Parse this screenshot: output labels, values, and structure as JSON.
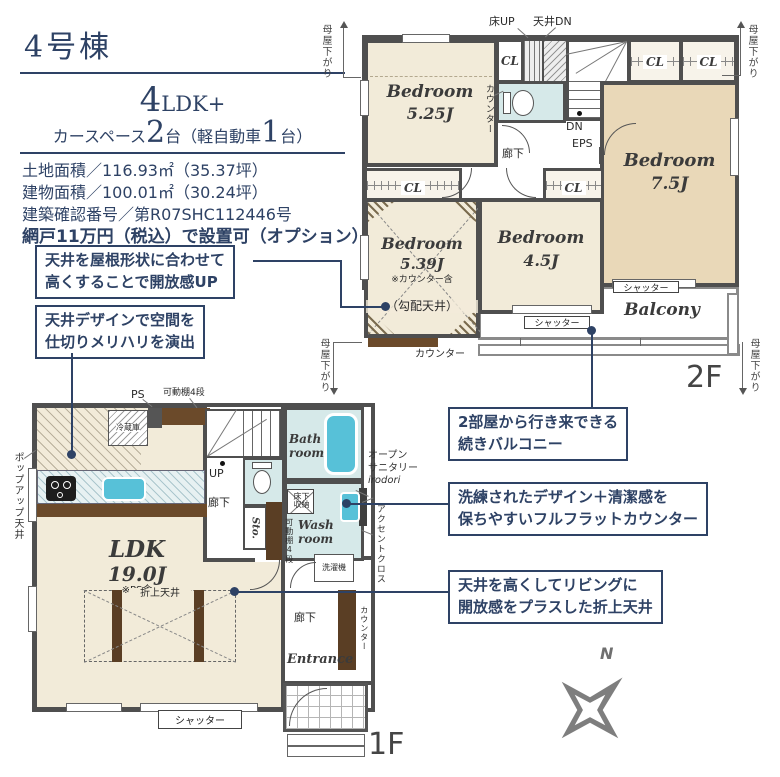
{
  "header": {
    "building": "4号棟",
    "plan_num": "4",
    "plan_rest": "LDK+",
    "car_prefix": "カースペース",
    "car_num1": "2",
    "car_mid": "台（軽自動車",
    "car_num2": "1",
    "car_suffix": "台）",
    "land": "土地面積／116.93㎡（35.37坪）",
    "bldg": "建物面積／100.01㎡（30.24坪）",
    "permit": "建築確認番号／第R07SHC112446号",
    "amido": "網戸11万円（税込）で設置可（オプション）"
  },
  "callouts": [
    {
      "line1": "天井を屋根形状に合わせて",
      "line2": "高くすることで開放感UP"
    },
    {
      "line1": "天井デザインで空間を",
      "line2": "仕切りメリハリを演出"
    },
    {
      "line1": "2部屋から行き来できる",
      "line2": "続きバルコニー"
    },
    {
      "line1": "洗練されたデザイン＋清潔感を",
      "line2": "保ちやすいフルフラットカウンター"
    },
    {
      "line1": "天井を高くしてリビングに",
      "line2": "開放感をプラスした折上天井"
    }
  ],
  "floor2": {
    "floor_label": "2F",
    "b1name": "Bedroom",
    "b1size": "5.25J",
    "b2name": "Bedroom",
    "b2size": "5.39J",
    "b2note": "※カウンター含",
    "b2ceil": "（勾配天井）",
    "b3name": "Bedroom",
    "b3size": "4.5J",
    "b4name": "Bedroom",
    "b4size": "7.5J",
    "balcony": "Balcony",
    "cl": "CL",
    "yuka_up": "床UP",
    "tenjo_dn": "天井DN",
    "dn": "DN",
    "eps": "EPS",
    "hallway": "廊下",
    "counter_side": "カウンター",
    "counter_bottom": "カウンター",
    "shutter": "シャッター",
    "moya": "母屋下がり"
  },
  "floor1": {
    "floor_label": "1F",
    "ldk": "LDK",
    "ldk_size": "19.0J",
    "ldk_note": "※PS含",
    "popup": "ポップアップ天井",
    "ps": "PS",
    "shelf_top": "可動棚4段",
    "fridge": "冷蔵庫",
    "up": "UP",
    "hall_up": "廊下",
    "sto": "Sto.",
    "bath1": "Bath",
    "bath2": "room",
    "wash1": "Wash",
    "wash2": "room",
    "ufs1": "床下",
    "ufs2": "収納",
    "shelf_v": "可動棚4段",
    "washer": "洗濯機",
    "osan1": "オープン",
    "osan2": "サニタリー",
    "osan3": "irodori",
    "accent": "アクセントクロス",
    "oriage": "折上天井",
    "shutter": "シャッター",
    "hall_low": "廊下",
    "counter_v": "カウンター",
    "entrance": "Entrance"
  },
  "compass": {
    "north": "N"
  },
  "colors": {
    "accent_navy": "#2e4265",
    "wall_gray": "#4f4f4f",
    "room_cream": "#f2ebd9",
    "room_tan": "#e9d8b8",
    "water_blue": "#57c1d8",
    "wet_area": "#d6e9e9",
    "wood_brown": "#6b4a2a"
  }
}
